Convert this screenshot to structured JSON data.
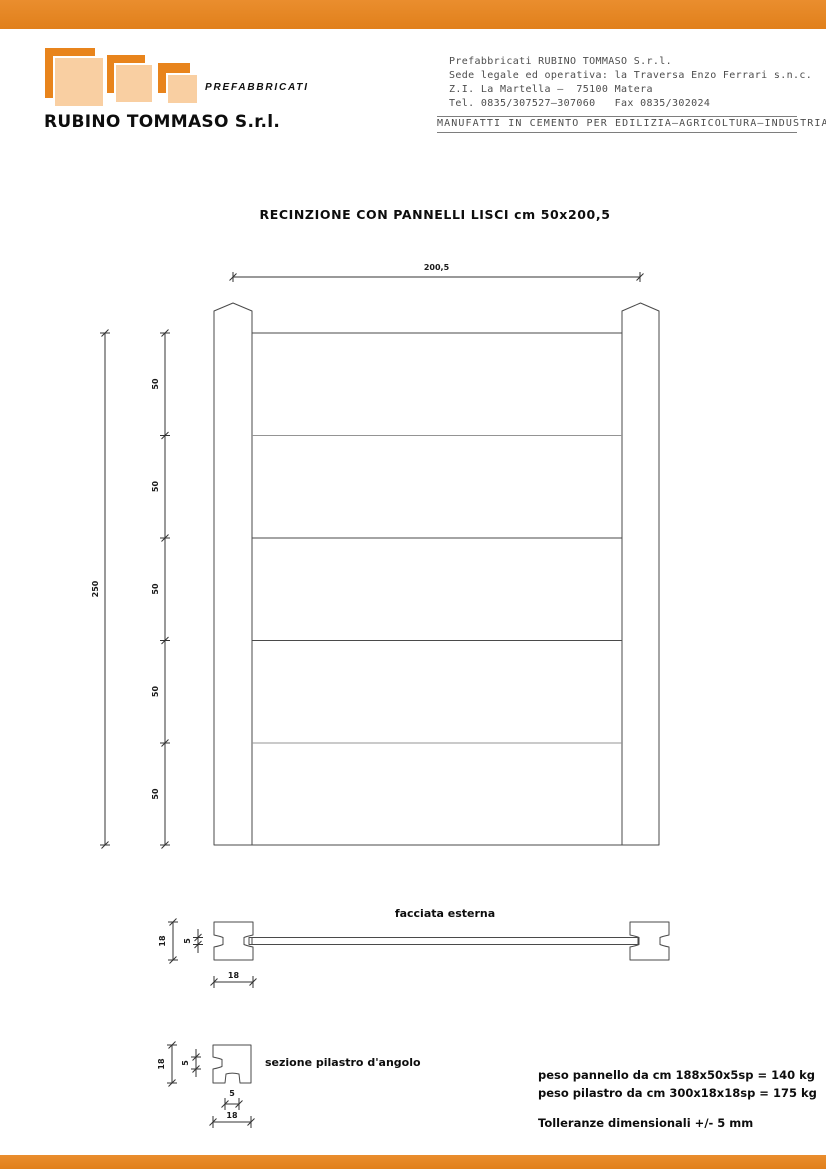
{
  "page": {
    "accent_orange": "#e8841c",
    "accent_peach": "#f9cfa2",
    "line_color": "#4a4a4a"
  },
  "header": {
    "logo": {
      "tagline": "PREFABBRICATI",
      "company": "RUBINO TOMMASO S.r.l."
    },
    "contact": {
      "line1": "Prefabbricati RUBINO TOMMASO S.r.l.",
      "line2": "Sede legale ed operativa: la Traversa Enzo Ferrari s.n.c.",
      "line3": "Z.I. La Martella –  75100 Matera",
      "line4": "Tel. 0835/307527–307060   Fax 0835/302024"
    },
    "sector": "MANUFATTI IN CEMENTO PER EDILIZIA–AGRICOLTURA–INDUSTRIA"
  },
  "drawing": {
    "title": "RECINZIONE CON PANNELLI LISCI cm 50x200,5",
    "width_dim": "200,5",
    "height_dim": "250",
    "segment_dims": [
      "50",
      "50",
      "50",
      "50",
      "50"
    ]
  },
  "facade_section": {
    "label": "facciata esterna",
    "post_height_dim": "18",
    "panel_thickness_dim": "5",
    "post_width_dim": "18"
  },
  "corner_section": {
    "label": "sezione pilastro d'angolo",
    "height_dim": "18",
    "notch_dim": "5",
    "slot_width_dim": "5",
    "width_dim": "18"
  },
  "notes": {
    "panel_weight": "peso pannello da cm 188x50x5sp = 140 kg",
    "post_weight": "peso pilastro da cm 300x18x18sp = 175 kg",
    "tolerance": "Tolleranze dimensionali +/- 5 mm"
  }
}
